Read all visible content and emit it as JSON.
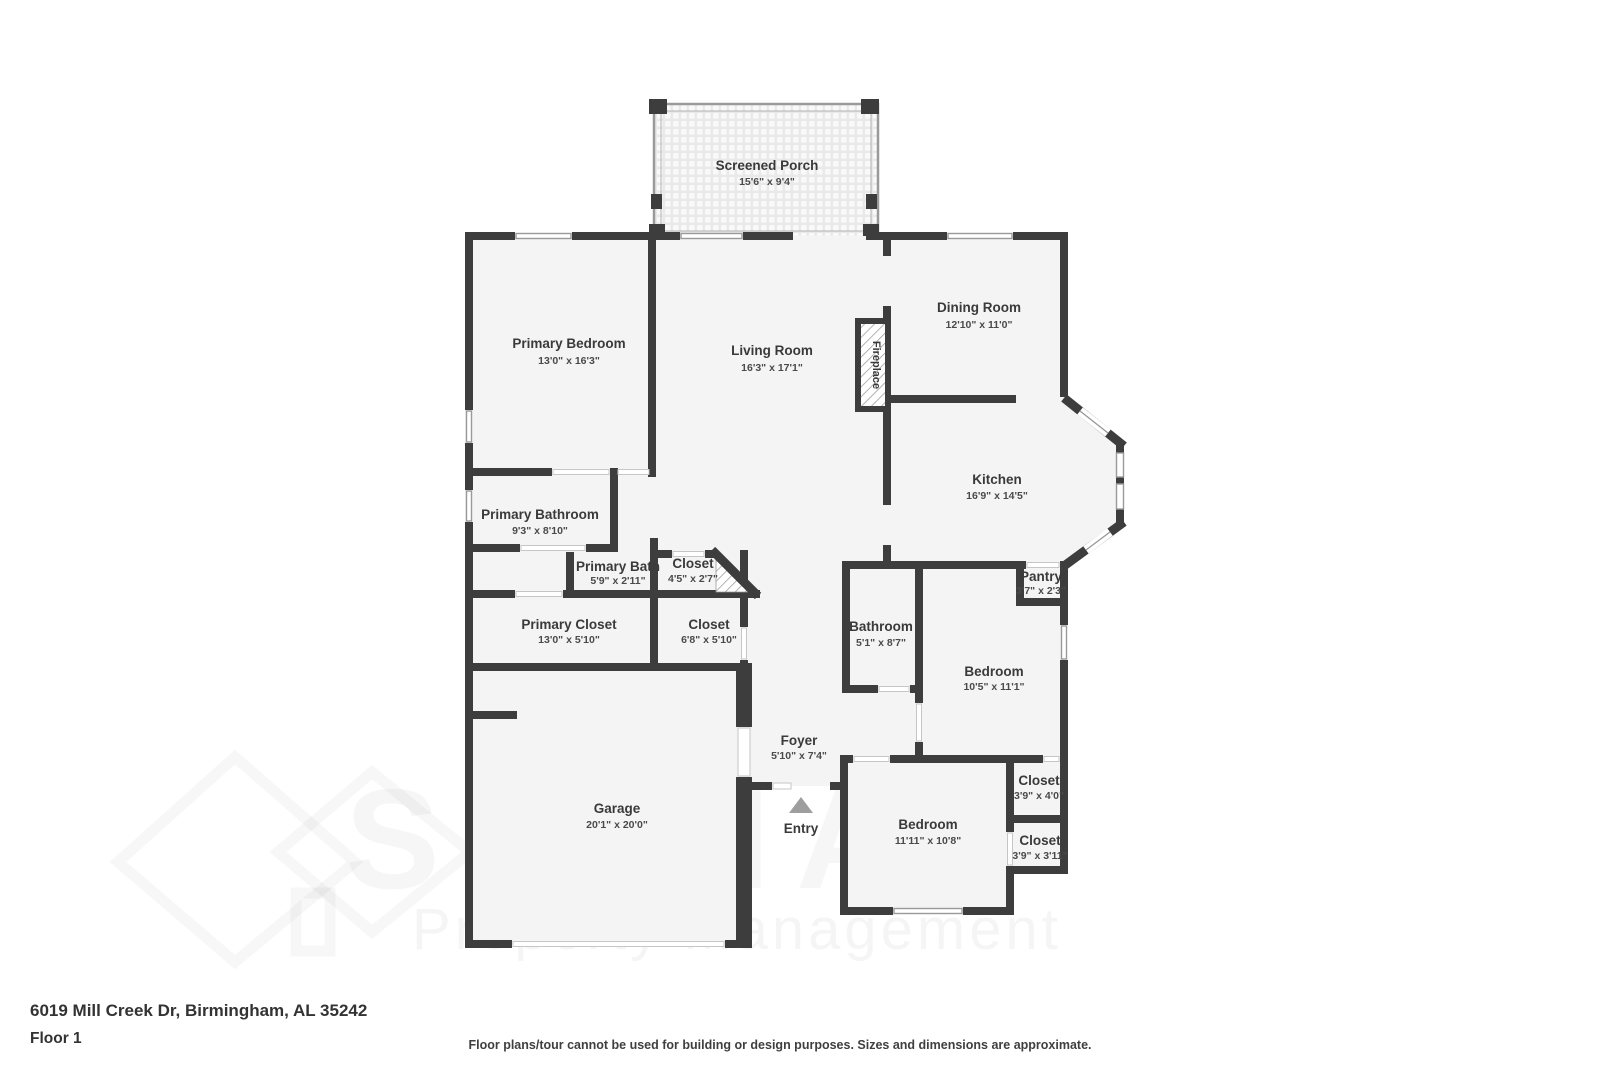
{
  "meta": {
    "address": "6019 Mill Creek Dr, Birmingham, AL 35242",
    "floor_label": "Floor 1",
    "disclaimer": "Floor plans/tour cannot be used for building or design purposes. Sizes and dimensions are approximate."
  },
  "watermark": {
    "brand": "SIGNAL",
    "tagline": "Property Management"
  },
  "floorplan": {
    "entry_label": "Entry",
    "fireplace_label": "Fireplace",
    "colors": {
      "wall": "#3d3d3d",
      "room_fill": "#f4f4f4",
      "window_frame": "#9a9a9a",
      "label_text": "#3a3a3a"
    },
    "rooms": [
      {
        "name": "Screened Porch",
        "dims": "15'6\" x 9'4\""
      },
      {
        "name": "Primary Bedroom",
        "dims": "13'0\" x 16'3\""
      },
      {
        "name": "Living Room",
        "dims": "16'3\" x 17'1\""
      },
      {
        "name": "Dining Room",
        "dims": "12'10\" x 11'0\""
      },
      {
        "name": "Kitchen",
        "dims": "16'9\" x 14'5\""
      },
      {
        "name": "Primary Bathroom",
        "dims": "9'3\" x 8'10\""
      },
      {
        "name": "Primary Bath",
        "dims": "5'9\" x 2'11\""
      },
      {
        "name": "Closet",
        "dims": "4'5\" x 2'7\""
      },
      {
        "name": "Primary Closet",
        "dims": "13'0\" x 5'10\""
      },
      {
        "name": "Closet",
        "dims": "6'8\" x 5'10\""
      },
      {
        "name": "Pantry",
        "dims": "3'7\" x 2'3\""
      },
      {
        "name": "Bathroom",
        "dims": "5'1\" x 8'7\""
      },
      {
        "name": "Bedroom",
        "dims": "10'5\" x 11'1\""
      },
      {
        "name": "Foyer",
        "dims": "5'10\" x 7'4\""
      },
      {
        "name": "Garage",
        "dims": "20'1\" x 20'0\""
      },
      {
        "name": "Bedroom",
        "dims": "11'11\" x 10'8\""
      },
      {
        "name": "Closet",
        "dims": "3'9\" x 4'0\""
      },
      {
        "name": "Closet",
        "dims": "3'9\" x 3'11\""
      }
    ]
  }
}
